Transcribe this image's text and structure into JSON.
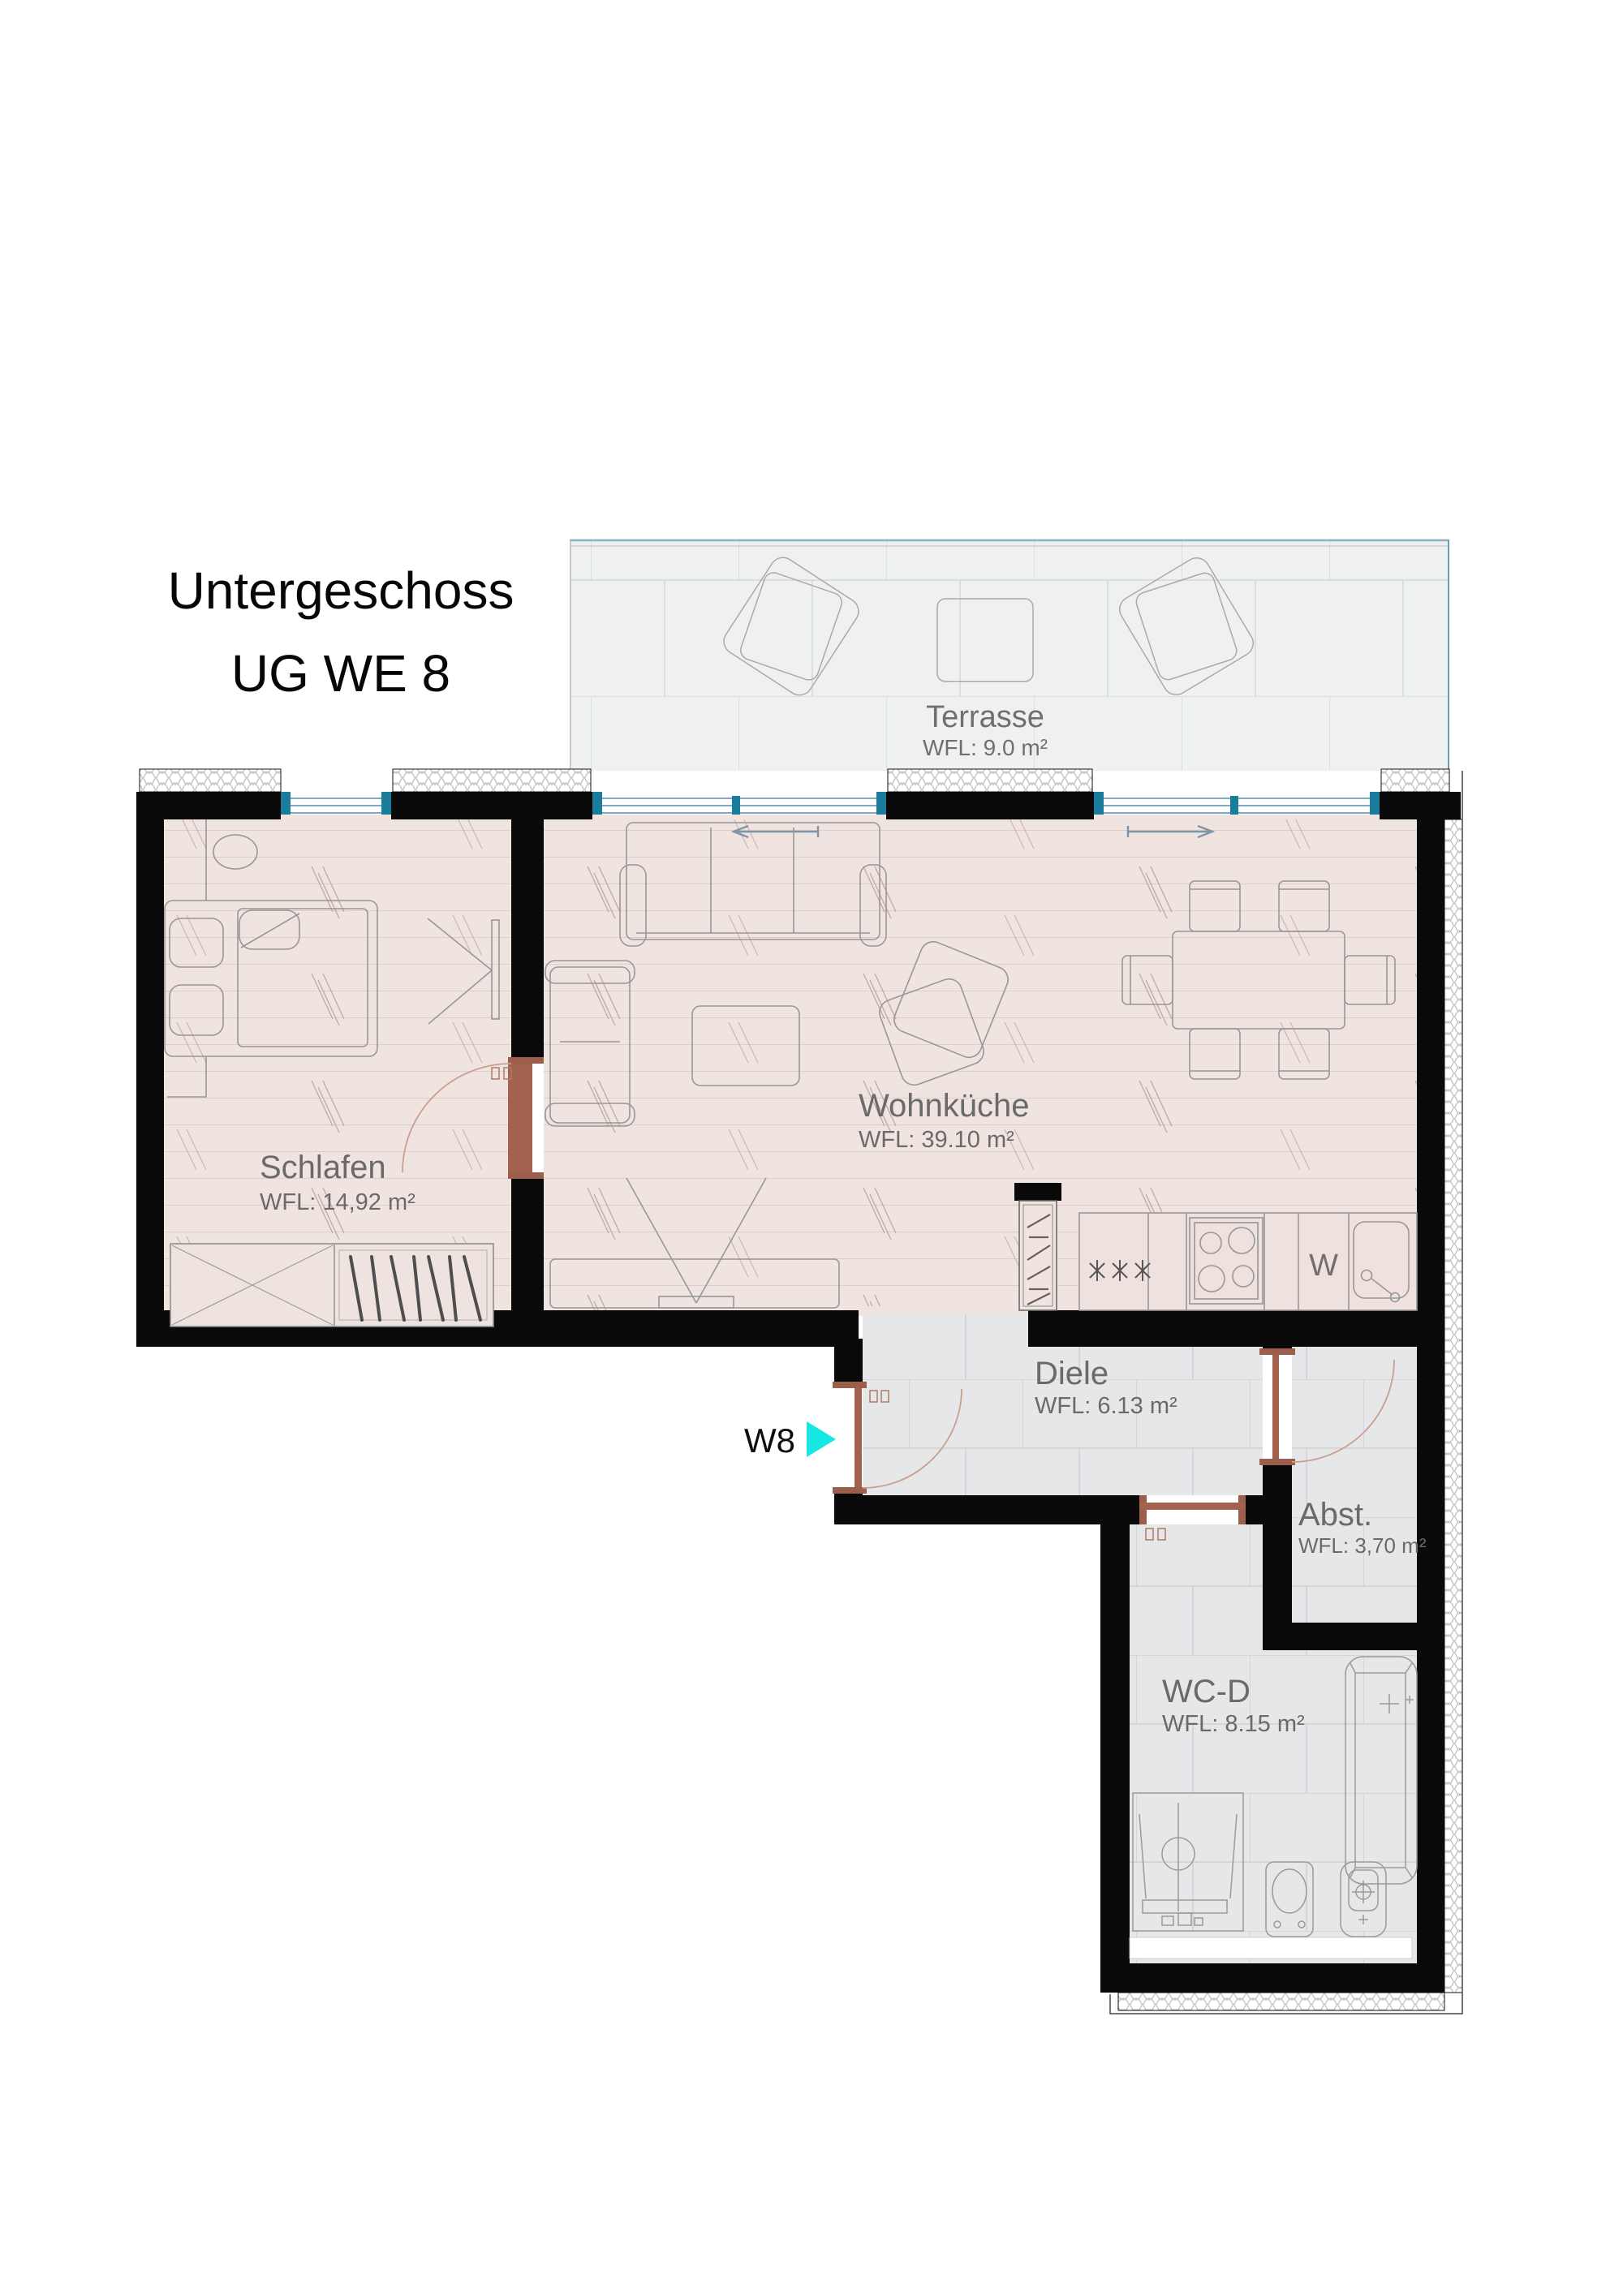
{
  "title": {
    "line1": "Untergeschoss",
    "line2": "UG WE 8"
  },
  "unit_marker": {
    "label": "W8"
  },
  "rooms": {
    "terrasse": {
      "name": "Terrasse",
      "area": "WFL: 9.0 m²"
    },
    "schlafen": {
      "name": "Schlafen",
      "area": "WFL: 14,92 m²"
    },
    "wohnkueche": {
      "name": "Wohnküche",
      "area": "WFL: 39.10 m²"
    },
    "diele": {
      "name": "Diele",
      "area": "WFL: 6.13 m²"
    },
    "abstellraum": {
      "name": "Abst.",
      "area": "WFL: 3,70 m²"
    },
    "wc_dusche": {
      "name": "WC-D",
      "area": "WFL: 8.15 m²"
    }
  },
  "kitchen": {
    "washer_label": "W"
  },
  "colors": {
    "wall": "#0a0a0a",
    "wood_floor": "#f0e4e0",
    "tile_floor": "#e5e7e8",
    "terrace_floor": "#eff1f0",
    "window_frame": "#1b7c9c",
    "door_wood": "#9c5f4b",
    "entry_arrow": "#17e8e4",
    "label_text": "#6a6a6a"
  }
}
